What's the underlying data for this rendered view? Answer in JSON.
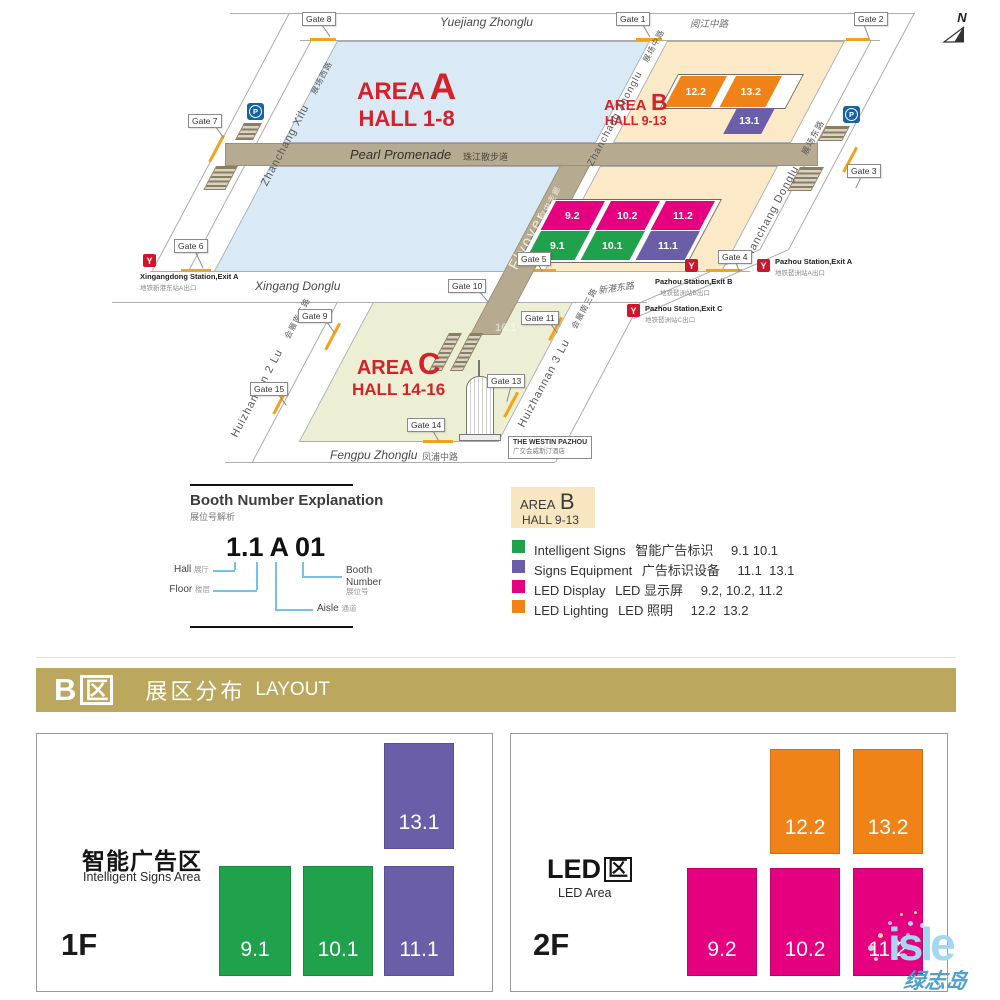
{
  "map": {
    "compass_label": "N",
    "icons": {
      "metro_glyph": "Y",
      "parking_glyph": "P"
    },
    "areas": [
      {
        "word": "AREA",
        "letter": "A",
        "hall": "HALL 1-8"
      },
      {
        "word": "AREA",
        "letter": "B",
        "hall": "HALL 9-13"
      },
      {
        "word": "AREA",
        "letter": "C",
        "hall": "HALL 14-16"
      }
    ],
    "roads": {
      "yuejiang_en": "Yuejiang Zhonglu",
      "yuejiang_zh": "阅江中路",
      "zhanchang_xilu_en": "Zhanchang Xilu",
      "zhanchang_xilu_zh": "展场西路",
      "zhanchang_zhonglu_en": "Zhanchang Zhonglu",
      "zhanchang_zhonglu_zh": "展场中路",
      "zhanchang_donglu_en": "Zhanchang Donglu",
      "zhanchang_donglu_zh": "展场东路",
      "xingang_en": "Xingang Donglu",
      "xingang_zh": "新港东路",
      "huizhannan2_en": "Huizhannan 2 Lu",
      "huizhannan2_zh": "会展南二路",
      "huizhannan3_en": "Huizhannan 3 Lu",
      "huizhannan3_zh": "会展南三路",
      "fengpu_en": "Fengpu Zhonglu",
      "fengpu_zh": "凤浦中路",
      "pearl_en": "Pearl Promenade",
      "pearl_zh": "珠江散步道",
      "flyover_en": "Flyover",
      "flyover_zh": "空中走廊"
    },
    "gates": [
      {
        "label": "Gate 8"
      },
      {
        "label": "Gate 1"
      },
      {
        "label": "Gate 2"
      },
      {
        "label": "Gate 7"
      },
      {
        "label": "Gate 6"
      },
      {
        "label": "Gate 3"
      },
      {
        "label": "Gate 5"
      },
      {
        "label": "Gate 4"
      },
      {
        "label": "Gate 10"
      },
      {
        "label": "Gate 9"
      },
      {
        "label": "Gate 11"
      },
      {
        "label": "Gate 15"
      },
      {
        "label": "Gate 13"
      },
      {
        "label": "Gate 14"
      }
    ],
    "stations": [
      {
        "en": "Xingangdong Station,Exit A",
        "zh": "地铁新港东站A出口"
      },
      {
        "en": "Pazhou Station,Exit B",
        "zh": "地铁琶洲站B出口"
      },
      {
        "en": "Pazhou Station,Exit A",
        "zh": "地铁琶洲站A出口"
      },
      {
        "en": "Pazhou Station,Exit C",
        "zh": "地铁琶洲站C出口"
      }
    ],
    "hotel": {
      "en": "THE WESTIN PAZHOU",
      "zh": "广交会威斯汀酒店"
    },
    "blocks": [
      {
        "label": "12.2"
      },
      {
        "label": "13.2"
      },
      {
        "label": "13.1"
      },
      {
        "label": "9.2"
      },
      {
        "label": "10.2"
      },
      {
        "label": "11.2"
      },
      {
        "label": "9.1"
      },
      {
        "label": "10.1"
      },
      {
        "label": "11.1"
      }
    ],
    "faint_hall": "16.1"
  },
  "booth_explanation": {
    "title_en": "Booth Number Explanation",
    "title_zh": "展位号解析",
    "example": {
      "hall_floor": "1.1",
      "aisle": "A",
      "booth": "01"
    },
    "callouts": {
      "hall_en": "Hall",
      "hall_zh": "展厅",
      "floor_en": "Floor",
      "floor_zh": "楼层",
      "aisle_en": "Aisle",
      "aisle_zh": "通道",
      "booth_en_line1": "Booth",
      "booth_en_line2": "Number",
      "booth_zh": "展位号"
    }
  },
  "legend": {
    "area_word": "AREA",
    "area_letter": "B",
    "area_hall": "HALL 9-13",
    "items": [
      {
        "en": "Intelligent Signs",
        "zh": "智能广告标识",
        "halls": "9.1 10.1",
        "color": "#1FA24B"
      },
      {
        "en": "Signs Equipment",
        "zh": "广告标识设备",
        "halls": "11.1  13.1",
        "color": "#6A5EA8"
      },
      {
        "en": "LED Display",
        "zh": "LED 显示屏",
        "halls": "9.2, 10.2, 11.2",
        "color": "#E4007F"
      },
      {
        "en": "LED Lighting",
        "zh": "LED 照明",
        "halls": "12.2  13.2",
        "color": "#F08318"
      }
    ]
  },
  "section_header": {
    "area_letter": "B",
    "area_char": "区",
    "title_zh": "展区分布",
    "title_en": "LAYOUT"
  },
  "floors": [
    {
      "id": "1F",
      "title": "智能广告区",
      "subtitle": "Intelligent Signs Area",
      "blocks": [
        {
          "label": "13.1"
        },
        {
          "label": "9.1"
        },
        {
          "label": "10.1"
        },
        {
          "label": "11.1"
        }
      ]
    },
    {
      "id": "2F",
      "title_prefix": "LED",
      "title_char": "区",
      "subtitle": "LED Area",
      "blocks": [
        {
          "label": "12.2"
        },
        {
          "label": "13.2"
        },
        {
          "label": "9.2"
        },
        {
          "label": "10.2"
        },
        {
          "label": "11.2"
        }
      ]
    }
  ],
  "watermark": {
    "text": "isle",
    "text_zh": "绿志岛"
  },
  "colors": {
    "intelligent_signs": "#1FA24B",
    "signs_equipment": "#6A5EA8",
    "led_display": "#E4007F",
    "led_lighting": "#F08318",
    "area_a_fill": "#D9EAF6",
    "area_b_fill": "#FBE9C8",
    "area_c_fill": "#ECEFD3",
    "promenade": "#B6AB90",
    "header_gold": "#BCA75F",
    "area_label_red": "#D62128",
    "metro_red": "#D0142C",
    "parking_blue": "#1463A8",
    "gate_tick_orange": "#F5A21B"
  }
}
